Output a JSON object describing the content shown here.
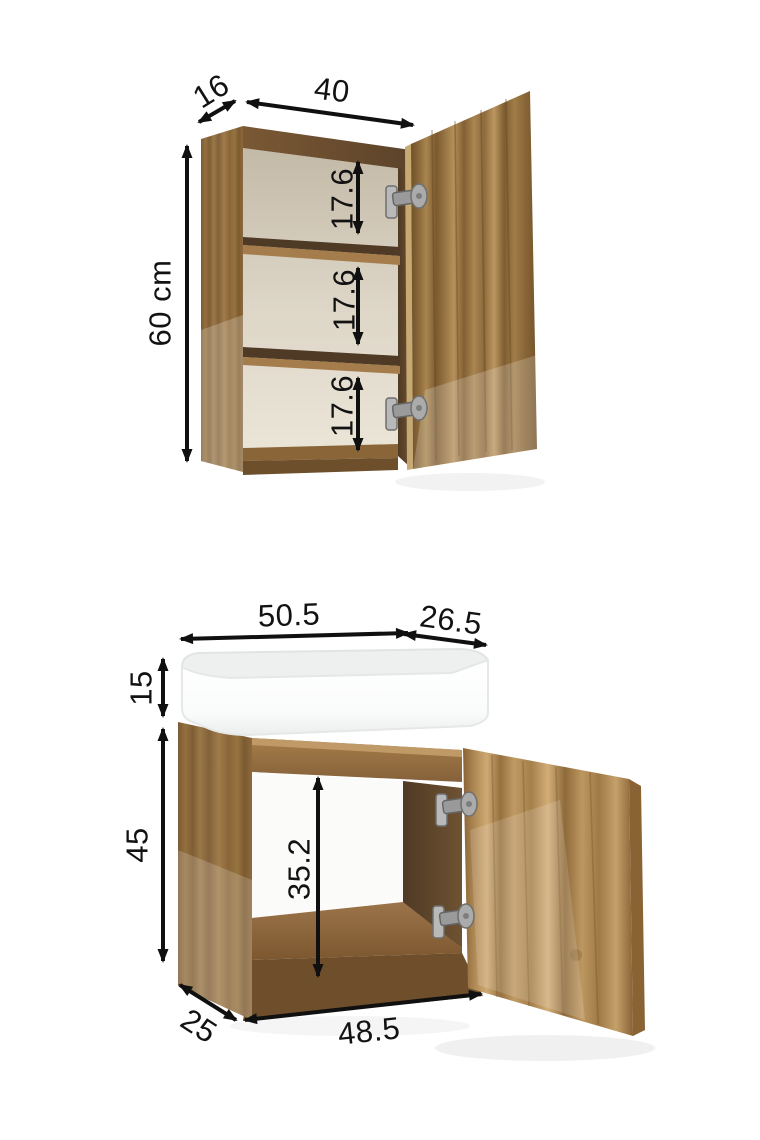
{
  "colors": {
    "background": "#ffffff",
    "dimension_lines": "#101010",
    "wood_dark": "#6d4f2c",
    "wood_mid": "#96713f",
    "wood_light": "#c9a873",
    "cabinet_interior": "#d9d2c3",
    "sink_white": "#f7f8f8",
    "hinge_metal": "#aaaaaa"
  },
  "top_diagram": {
    "name": "wall cabinet with open door and two shelves",
    "dims": {
      "depth": "16",
      "width": "40",
      "height": "60 cm",
      "gap1": "17.6",
      "gap2": "17.6",
      "gap3": "17.6"
    }
  },
  "bottom_diagram": {
    "name": "vanity unit with basin and open door",
    "dims": {
      "top_width": "50.5",
      "door_width": "26.5",
      "basin_height": "15",
      "body_height": "45",
      "interior_height": "35.2",
      "depth": "25",
      "interior_width": "48.5"
    }
  }
}
